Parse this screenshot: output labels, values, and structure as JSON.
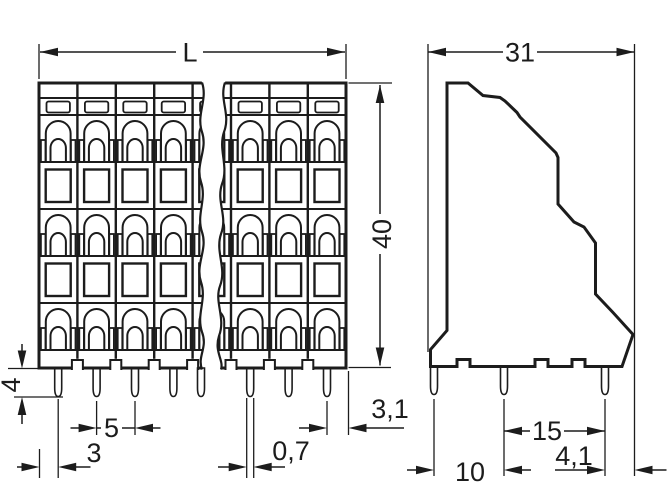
{
  "drawing": {
    "subject": "terminal-block-dimension-drawing",
    "views": {
      "front": {
        "name": "front-view",
        "poles_visible": 8,
        "clamp_levels": 3,
        "dimensions": {
          "overall_width": "L",
          "height": "40",
          "pin_length": "4",
          "pole_pitch": "5",
          "first_pin_offset": "3",
          "pin_width": "0,7",
          "last_pin_offset": "3,1"
        }
      },
      "side": {
        "name": "side-view",
        "pins_visible": 3,
        "dimensions": {
          "overall_depth": "31",
          "pin_row_spacing_rear": "15",
          "pin_to_rear_edge": "4,1",
          "pin_row_spacing_front": "10"
        }
      }
    },
    "colors": {
      "housing": "#c6c7c8",
      "contact": "#f5b87c",
      "line": "#1c1c1c",
      "background": "#ffffff"
    }
  }
}
